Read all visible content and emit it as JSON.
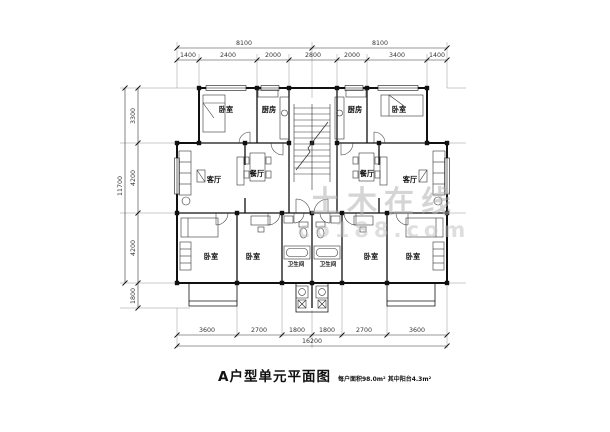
{
  "title": {
    "main": "A户型单元平面图",
    "sub": "每户面积98.0m² 其中阳台4.3m²"
  },
  "watermark": {
    "line1": "土木在线",
    "line2": "co188.com"
  },
  "room_labels": {
    "bedroom": "卧室",
    "kitchen": "厨房",
    "living": "客厅",
    "dining": "餐厅",
    "bathroom": "卫生间"
  },
  "dimensions": {
    "top_overall": [
      "8100",
      "8100"
    ],
    "top_segments": [
      "1400",
      "2400",
      "2000",
      "2800",
      "2000",
      "3400",
      "1400"
    ],
    "left_overall": "11700",
    "left_segments": [
      "3300",
      "4200",
      "4200",
      "1800"
    ],
    "bottom_segments": [
      "3600",
      "2700",
      "1800",
      "1800",
      "2700",
      "3600"
    ],
    "bottom_overall": "16200"
  }
}
